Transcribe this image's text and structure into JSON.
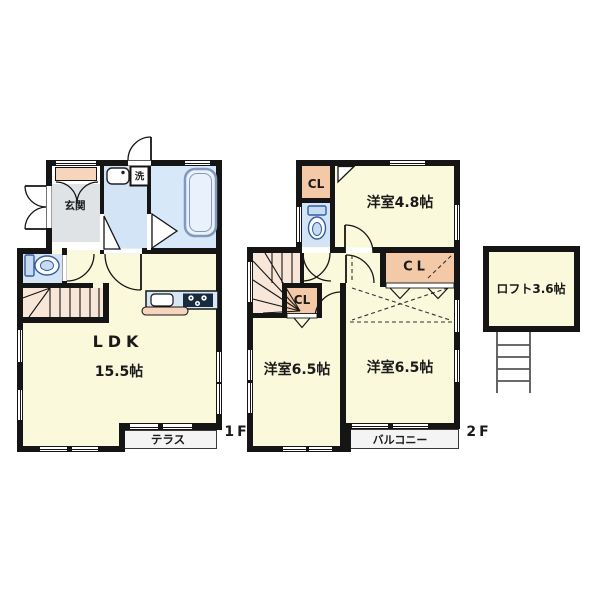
{
  "colors": {
    "wall": "#151515",
    "room-yellow": "#FAF9DC",
    "water-blue": "#D2E4F5",
    "bath-blue": "#D7E8F8",
    "closet-pink": "#F4C9A7",
    "cabinet-pink": "#F7D4BC",
    "stairs-peach": "#F8E6D8",
    "genkan-gray": "#E0E3E6",
    "deck-gray": "#F4F4F4",
    "counter-blue": "#D8E7F6",
    "fixture-blue": "#345D9E",
    "text": "#1A1A1A"
  },
  "floor1": {
    "label": "1F",
    "genkan": "玄関",
    "laundry": "洗",
    "ldk_name": "LDK",
    "ldk_size": "15.5帖",
    "terrace": "テラス"
  },
  "floor2": {
    "label": "2F",
    "closet_top": "CL",
    "closet_mid": "CL",
    "closet_right": "CL",
    "room_48": "洋室4.8帖",
    "room_65_left": "洋室6.5帖",
    "room_65_right": "洋室6.5帖",
    "balcony": "バルコニー"
  },
  "loft": {
    "label": "ロフト3.6帖"
  }
}
